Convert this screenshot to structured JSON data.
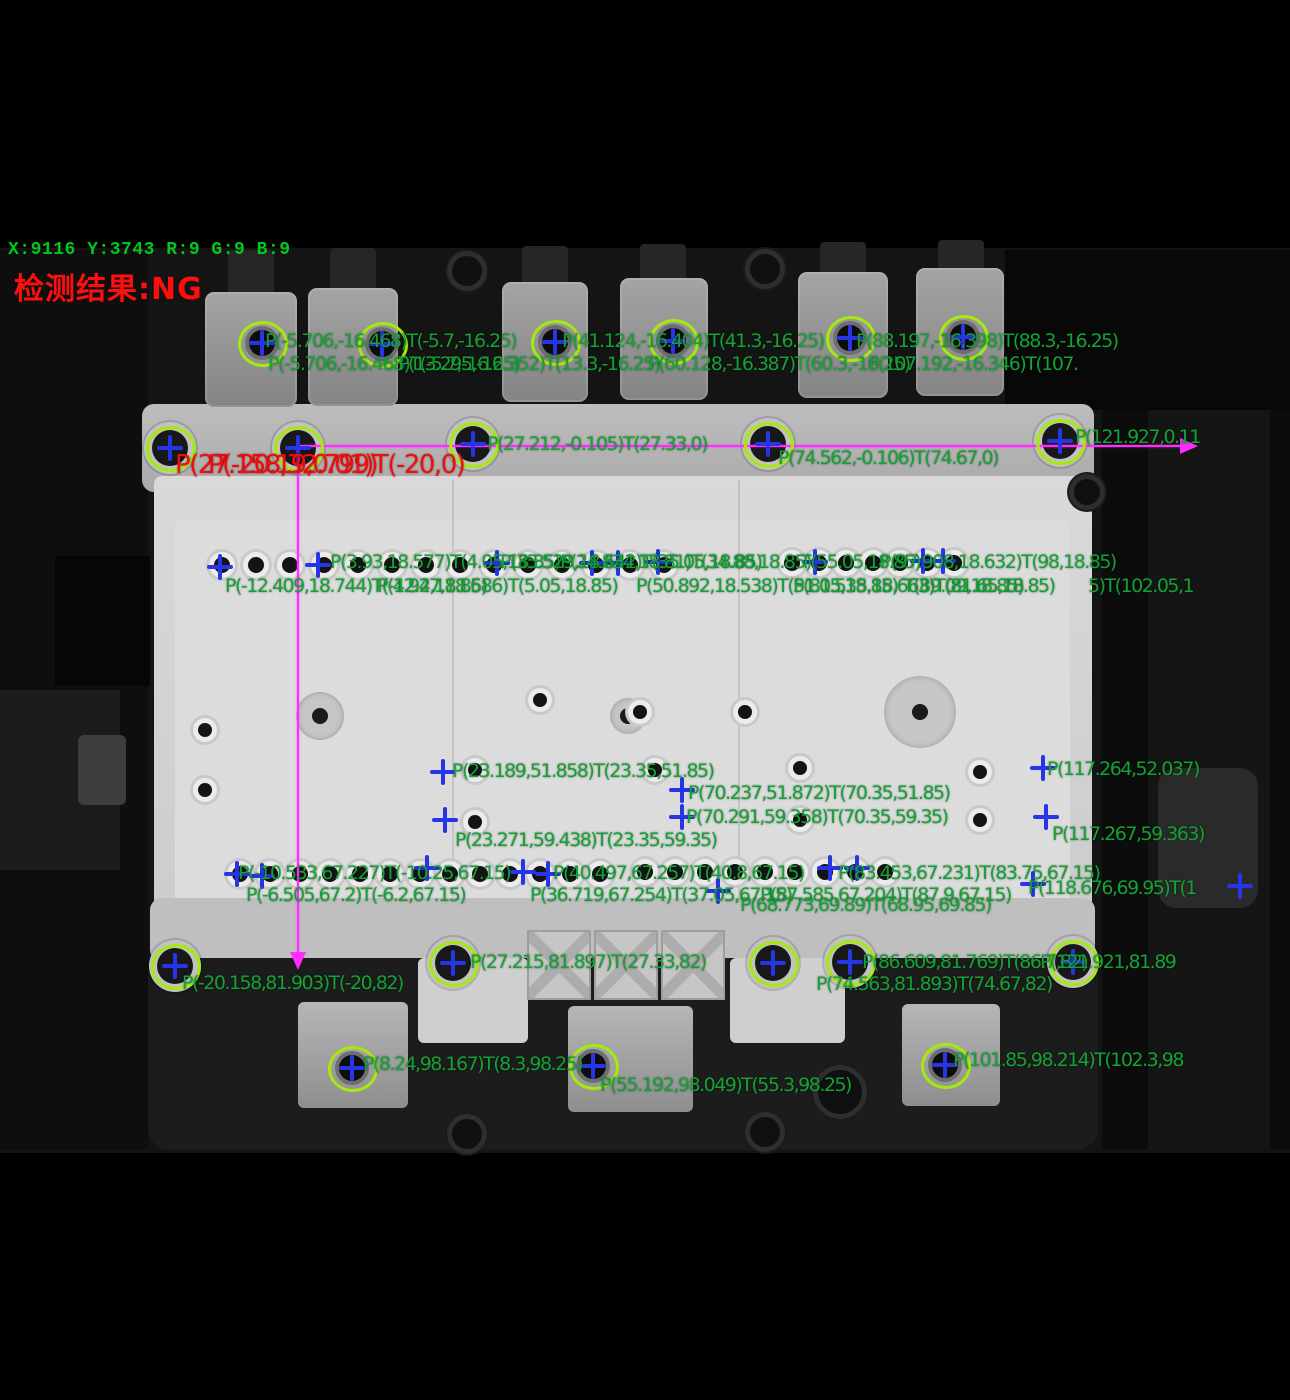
{
  "status_bar": {
    "text": "X:9116 Y:3743 R:9 G:9 B:9"
  },
  "result_banner": {
    "text": "检测结果:NG",
    "state": "NG"
  },
  "colors": {
    "overlay_green": "#13a234",
    "overlay_red": "#f20d0d",
    "marker_blue": "#2635e6",
    "marker_circle": "#a6e90e",
    "measure_magenta": "#ff2dff",
    "status_green": "#00c81e"
  },
  "measurements": {
    "green_labels": [
      {
        "text": "P(-5.706,-16.468)T(-5.7,-16.25)",
        "x": 265,
        "y": 332
      },
      {
        "text": "P(41.124,-16.404)T(41.3,-16.25)",
        "x": 562,
        "y": 332
      },
      {
        "text": "P(88.197,-16.398)T(88.3,-16.25)",
        "x": 856,
        "y": 332
      },
      {
        "text": "P(-5.706,-16.468)T(-5.7,-16.25)",
        "x": 268,
        "y": 355
      },
      {
        "text": "P(13.295,-16.352)T(13.3,-16.25)",
        "x": 398,
        "y": 355
      },
      {
        "text": "P(60.128,-16.387)T(60.3,-16.25)",
        "x": 648,
        "y": 355
      },
      {
        "text": "P(107.192,-16.346)T(107.",
        "x": 868,
        "y": 355
      },
      {
        "text": "P(27.212,-0.105)T(27.33,0)",
        "x": 487,
        "y": 435
      },
      {
        "text": "P(74.562,-0.106)T(74.67,0)",
        "x": 778,
        "y": 449
      },
      {
        "text": "P(121.927,0.11",
        "x": 1075,
        "y": 428
      },
      {
        "text": "P(3.93,18.577)T(4.05,18.85)",
        "x": 330,
        "y": 553
      },
      {
        "text": "P(35.529,18.642)T(35.05,18.85)",
        "x": 500,
        "y": 553
      },
      {
        "text": "P(24.834,18.81)T(34.88,18.85)",
        "x": 560,
        "y": 553
      },
      {
        "text": "T(55.05,18.85)",
        "x": 800,
        "y": 553
      },
      {
        "text": "P(97.908,18.632)T(98,18.85)",
        "x": 880,
        "y": 553
      },
      {
        "text": "P(-12.409,18.744)T(-12.2,18.85)",
        "x": 225,
        "y": 577
      },
      {
        "text": "P(4.947,18.686)T(5.05,18.85)",
        "x": 377,
        "y": 577
      },
      {
        "text": "P(50.892,18.538)T(51.05,18.85)",
        "x": 636,
        "y": 577
      },
      {
        "text": "P(81.535,18.663)T(81.65,18.85)",
        "x": 793,
        "y": 577
      },
      {
        "text": "T(89.09,18.85)",
        "x": 903,
        "y": 577
      },
      {
        "text": "5)T(102.05,1",
        "x": 1088,
        "y": 577
      },
      {
        "text": "P(23.189,51.858)T(23.35,51.85)",
        "x": 452,
        "y": 762
      },
      {
        "text": "P(70.237,51.872)T(70.35,51.85)",
        "x": 688,
        "y": 784
      },
      {
        "text": "P(70.291,59.358)T(70.35,59.35)",
        "x": 686,
        "y": 808
      },
      {
        "text": "P(23.271,59.438)T(23.35,59.35)",
        "x": 455,
        "y": 831
      },
      {
        "text": "P(117.264,52.037)",
        "x": 1047,
        "y": 760
      },
      {
        "text": "P(117.267,59.363)",
        "x": 1052,
        "y": 825
      },
      {
        "text": "P(-10.533,67.227)T(-10.25,67.15)",
        "x": 238,
        "y": 864
      },
      {
        "text": "P(40.497,67.257)T(40.8,67.15)",
        "x": 553,
        "y": 864
      },
      {
        "text": "P(83.453,67.231)T(83.75,67.15)",
        "x": 838,
        "y": 864
      },
      {
        "text": "P(-6.505,67.2)T(-6.2,67.15)",
        "x": 246,
        "y": 886
      },
      {
        "text": "P(36.719,67.254)T(37.05,67.15)",
        "x": 530,
        "y": 886
      },
      {
        "text": "P(87.585,67.204)T(87.9,67.15)",
        "x": 760,
        "y": 886
      },
      {
        "text": "P(118.676,69.95)T(1",
        "x": 1028,
        "y": 879
      },
      {
        "text": "P(68.773,69.89)T(68.95,69.85)",
        "x": 740,
        "y": 896
      },
      {
        "text": "P(27.215,81.897)T(27.33,82)",
        "x": 470,
        "y": 953
      },
      {
        "text": "P(86.609,81.769)T(86.7,82)",
        "x": 862,
        "y": 953
      },
      {
        "text": "P(121.921,81.89",
        "x": 1040,
        "y": 953
      },
      {
        "text": "P(74.563,81.893)T(74.67,82)",
        "x": 816,
        "y": 975
      },
      {
        "text": "P(-20.158,81.903)T(-20,82)",
        "x": 182,
        "y": 974
      },
      {
        "text": "P(8.24,98.167)T(8.3,98.25)",
        "x": 363,
        "y": 1055
      },
      {
        "text": "P(55.192,98.049)T(55.3,98.25)",
        "x": 600,
        "y": 1076
      },
      {
        "text": "P(101.85,98.214)T(102.3,98",
        "x": 953,
        "y": 1051
      }
    ],
    "red_labels": [
      {
        "text": "P(27.158,32.799)",
        "x": 175,
        "y": 452
      },
      {
        "text": "P(-20.19,0.01)T(-20,0)",
        "x": 208,
        "y": 452
      }
    ]
  },
  "markers": {
    "circled": [
      {
        "x": 262,
        "y": 343
      },
      {
        "x": 382,
        "y": 344
      },
      {
        "x": 555,
        "y": 342
      },
      {
        "x": 673,
        "y": 341
      },
      {
        "x": 850,
        "y": 338
      },
      {
        "x": 963,
        "y": 337
      },
      {
        "x": 170,
        "y": 448
      },
      {
        "x": 298,
        "y": 448
      },
      {
        "x": 473,
        "y": 444
      },
      {
        "x": 768,
        "y": 444
      },
      {
        "x": 1060,
        "y": 441
      },
      {
        "x": 175,
        "y": 966
      },
      {
        "x": 453,
        "y": 963
      },
      {
        "x": 773,
        "y": 963
      },
      {
        "x": 850,
        "y": 962
      },
      {
        "x": 1073,
        "y": 962
      },
      {
        "x": 352,
        "y": 1068
      },
      {
        "x": 593,
        "y": 1066
      },
      {
        "x": 945,
        "y": 1065
      }
    ],
    "plain": [
      {
        "x": 220,
        "y": 567
      },
      {
        "x": 318,
        "y": 565
      },
      {
        "x": 497,
        "y": 563
      },
      {
        "x": 592,
        "y": 563
      },
      {
        "x": 618,
        "y": 563
      },
      {
        "x": 658,
        "y": 562
      },
      {
        "x": 815,
        "y": 562
      },
      {
        "x": 923,
        "y": 561
      },
      {
        "x": 943,
        "y": 561
      },
      {
        "x": 443,
        "y": 772
      },
      {
        "x": 445,
        "y": 820
      },
      {
        "x": 682,
        "y": 790
      },
      {
        "x": 682,
        "y": 817
      },
      {
        "x": 1043,
        "y": 768
      },
      {
        "x": 1046,
        "y": 817
      },
      {
        "x": 237,
        "y": 874
      },
      {
        "x": 262,
        "y": 876
      },
      {
        "x": 427,
        "y": 868
      },
      {
        "x": 523,
        "y": 872
      },
      {
        "x": 548,
        "y": 874
      },
      {
        "x": 718,
        "y": 891
      },
      {
        "x": 830,
        "y": 868
      },
      {
        "x": 857,
        "y": 868
      },
      {
        "x": 1033,
        "y": 884
      },
      {
        "x": 1240,
        "y": 886
      }
    ]
  },
  "measure_lines": {
    "horizontal": {
      "x1": 300,
      "y": 445,
      "x2": 1180,
      "arrow": "right"
    },
    "vertical": {
      "x": 297,
      "y1": 447,
      "y2": 952,
      "arrow": "down"
    }
  }
}
